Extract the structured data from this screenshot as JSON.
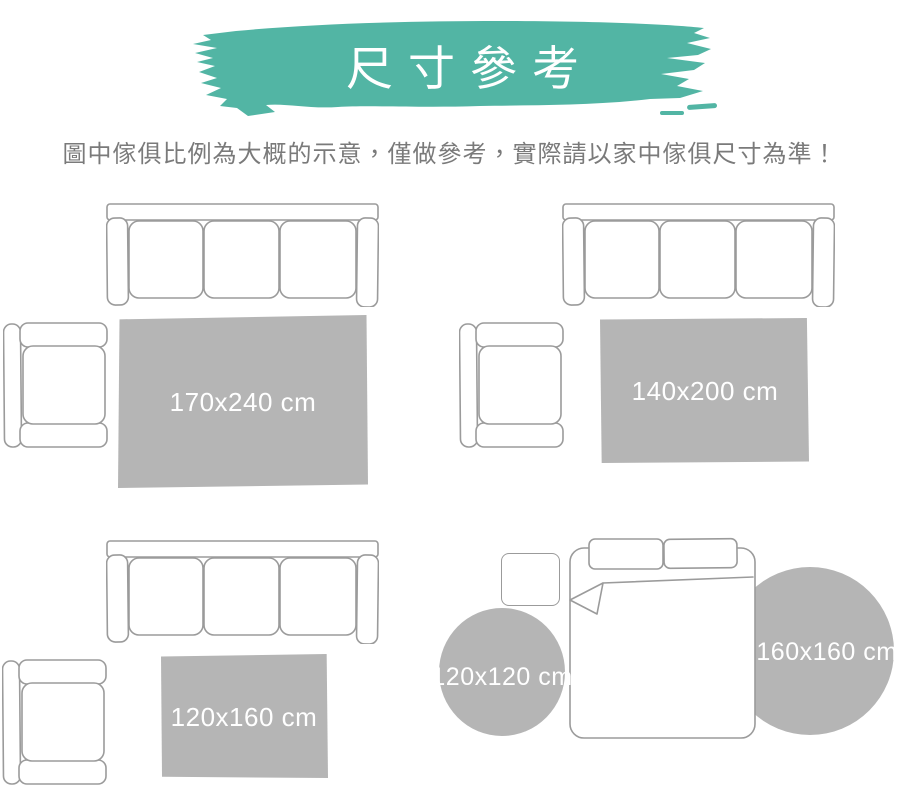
{
  "header": {
    "title": "尺寸參考",
    "banner_color": "#52b5a4",
    "subtitle": "圖中傢俱比例為大概的示意，僅做參考，實際請以家中傢俱尺寸為準！"
  },
  "palette": {
    "rug_fill": "#b5b5b5",
    "furniture_outline": "#9b9b9b",
    "rug_label_text": "#ffffff",
    "subtitle_text": "#7a7a7a"
  },
  "scenes": [
    {
      "name": "living-room-large",
      "furniture": [
        "three-seat-sofa",
        "armchair"
      ],
      "rug": {
        "shape": "rectangle",
        "size_label": "170x240 cm"
      }
    },
    {
      "name": "living-room-medium",
      "furniture": [
        "three-seat-sofa",
        "armchair"
      ],
      "rug": {
        "shape": "rectangle",
        "size_label": "140x200 cm"
      }
    },
    {
      "name": "living-room-small",
      "furniture": [
        "three-seat-sofa",
        "armchair"
      ],
      "rug": {
        "shape": "rectangle",
        "size_label": "120x160 cm"
      }
    },
    {
      "name": "bedroom",
      "furniture": [
        "double-bed",
        "nightstand"
      ],
      "rugs": [
        {
          "shape": "round",
          "size_label": "120x120 cm"
        },
        {
          "shape": "round",
          "size_label": "160x160 cm"
        }
      ]
    }
  ]
}
